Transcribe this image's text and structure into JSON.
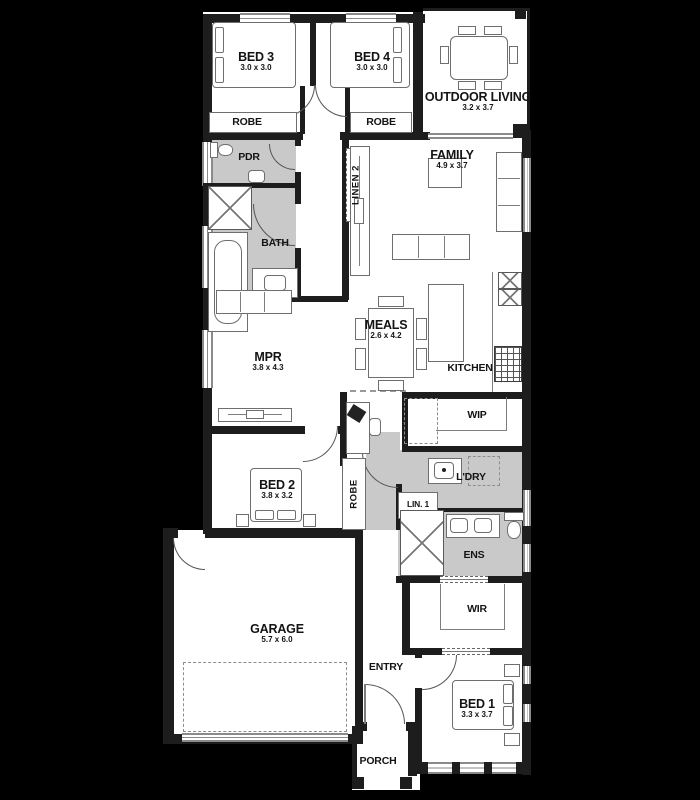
{
  "plan": {
    "title": "single-storey house floor plan",
    "rooms": {
      "bed3": {
        "label": "BED 3",
        "dims": "3.0 x 3.0"
      },
      "bed4": {
        "label": "BED 4",
        "dims": "3.0 x 3.0"
      },
      "outdoor_living": {
        "label": "OUTDOOR LIVING",
        "dims": "3.2 x 3.7"
      },
      "robe_bed3": {
        "label": "ROBE"
      },
      "robe_bed4": {
        "label": "ROBE"
      },
      "pdr": {
        "label": "PDR"
      },
      "linen2": {
        "label": "LINEN 2"
      },
      "family": {
        "label": "FAMILY",
        "dims": "4.9 x 3.7"
      },
      "bath": {
        "label": "BATH"
      },
      "meals": {
        "label": "MEALS",
        "dims": "2.6 x 4.2"
      },
      "mpr": {
        "label": "MPR",
        "dims": "3.8 x 4.3"
      },
      "kitchen": {
        "label": "KITCHEN"
      },
      "wip": {
        "label": "WIP"
      },
      "bed2": {
        "label": "BED 2",
        "dims": "3.8 x 3.2"
      },
      "robe_bed2": {
        "label": "ROBE"
      },
      "ldry": {
        "label": "L'DRY"
      },
      "lin1": {
        "label": "LIN. 1"
      },
      "ens": {
        "label": "ENS"
      },
      "wir": {
        "label": "WIR"
      },
      "garage": {
        "label": "GARAGE",
        "dims": "5.7 x 6.0"
      },
      "entry": {
        "label": "ENTRY"
      },
      "bed1": {
        "label": "BED 1",
        "dims": "3.3 x 3.7"
      },
      "porch": {
        "label": "PORCH"
      }
    },
    "colors": {
      "background": "#000000",
      "wall": "#1d1d1d",
      "floor": "#ffffff",
      "wet_area_floor": "#c9c9c9",
      "furniture_line": "#6e6e6e"
    }
  }
}
